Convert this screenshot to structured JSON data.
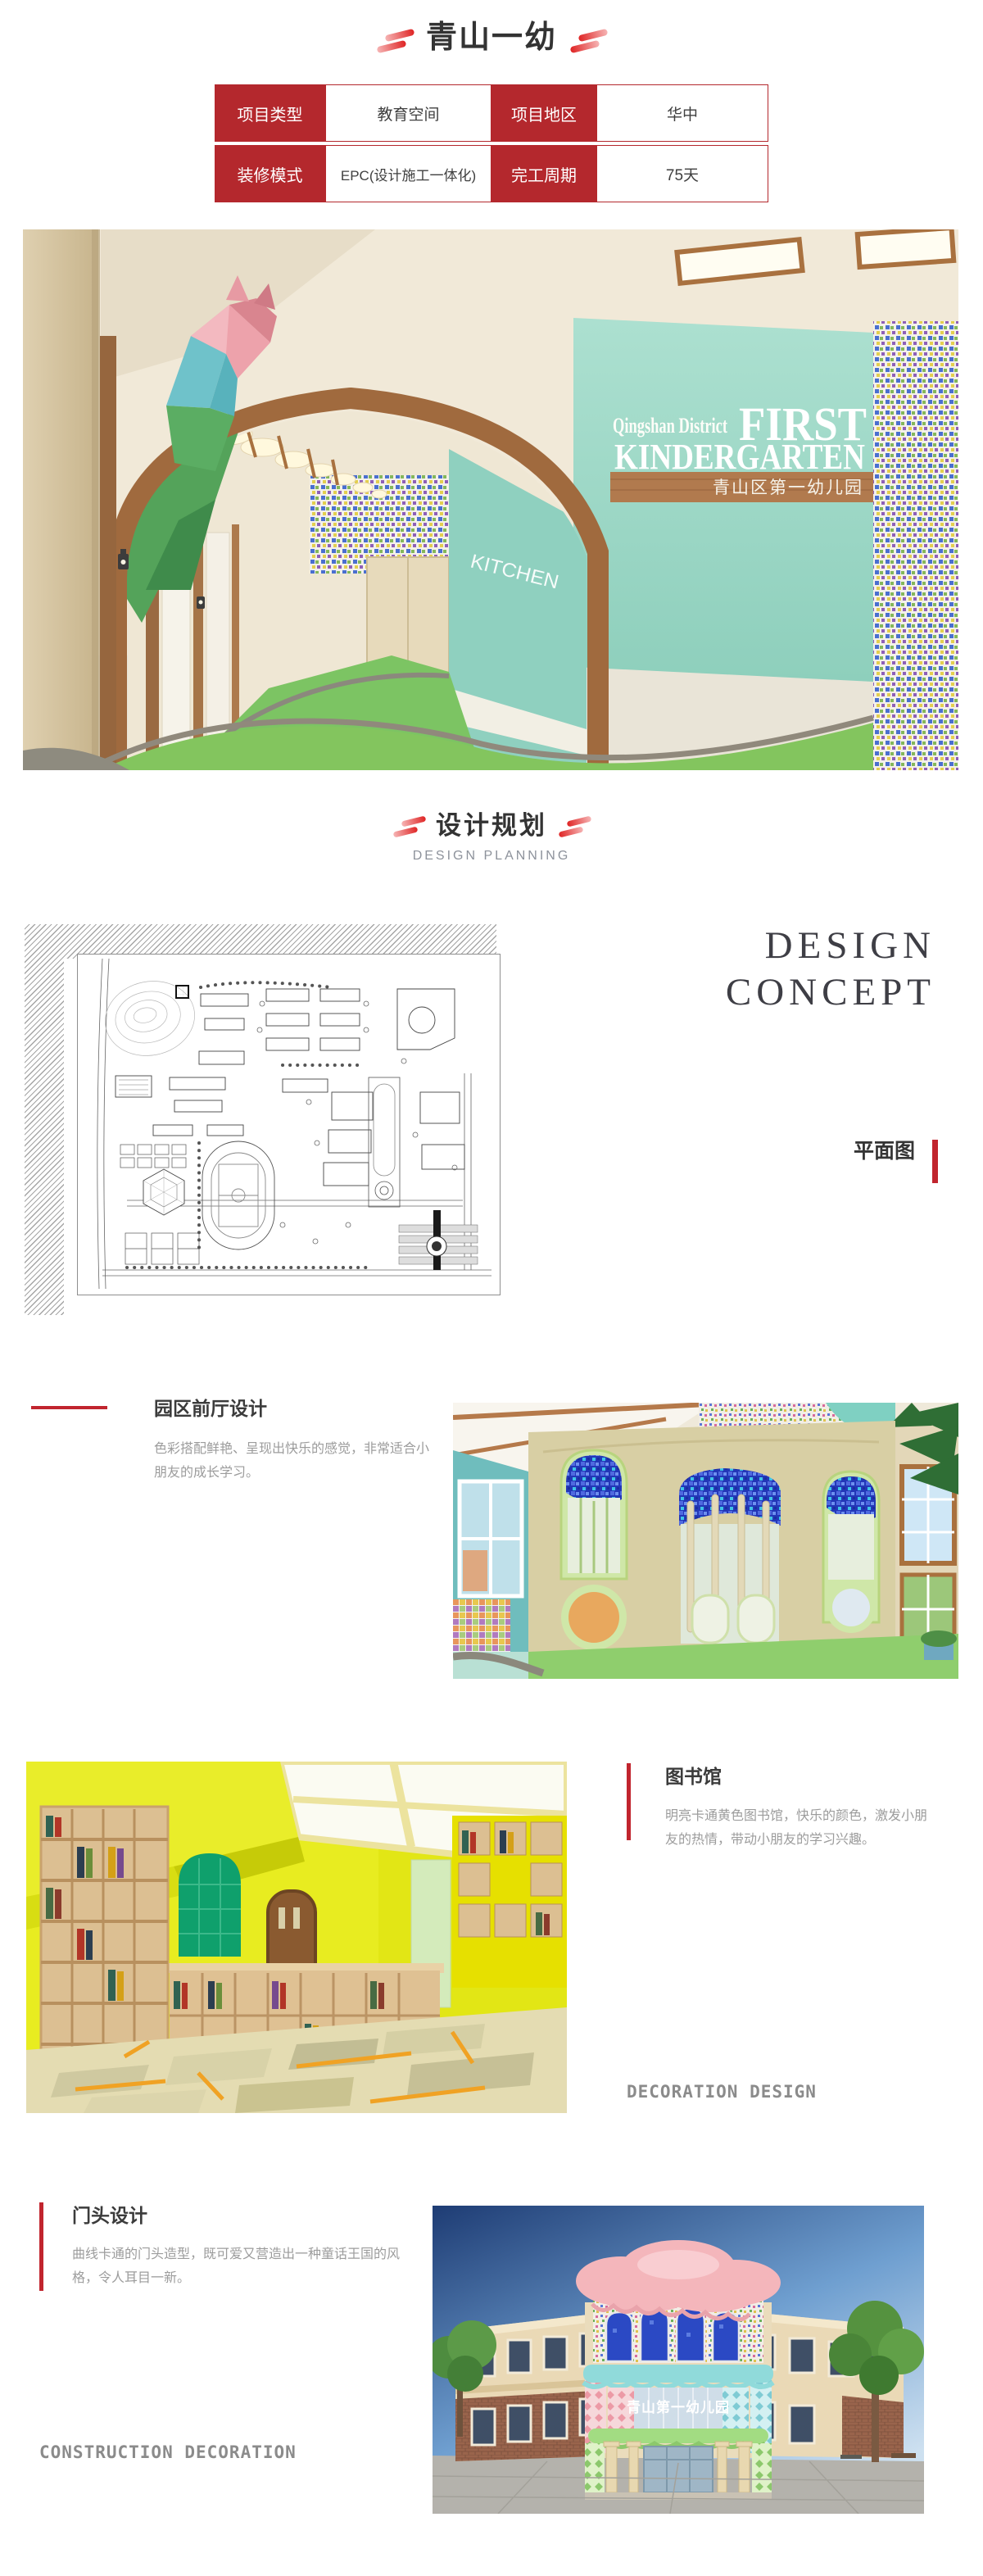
{
  "header": {
    "title": "青山一幼"
  },
  "info_table": {
    "rows": [
      {
        "cells": [
          {
            "kind": "label",
            "text": "项目类型"
          },
          {
            "kind": "value",
            "text": "教育空间"
          },
          {
            "kind": "label",
            "text": "项目地区"
          },
          {
            "kind": "value",
            "text": "华中"
          }
        ]
      },
      {
        "cells": [
          {
            "kind": "label",
            "text": "装修模式"
          },
          {
            "kind": "value",
            "text": "EPC(设计施工一体化)"
          },
          {
            "kind": "label",
            "text": "完工周期"
          },
          {
            "kind": "value",
            "text": "75天"
          }
        ]
      }
    ]
  },
  "hero": {
    "wall_text_small": "Qingshan District",
    "wall_text_line1": "FIRST",
    "wall_text_line2": "KINDERGARTEN",
    "board_text": "青山区第一幼儿园",
    "corridor_label": "KITCHEN"
  },
  "planning_header": {
    "title": "设计规划",
    "subtitle": "DESIGN PLANNING"
  },
  "concept": {
    "line1": "DESIGN",
    "line2": "CONCEPT",
    "plan_label": "平面图"
  },
  "sections": {
    "lobby": {
      "title": "园区前厅设计",
      "description": "色彩搭配鲜艳、呈现出快乐的感觉，非常适合小朋友的成长学习。"
    },
    "library": {
      "title": "图书馆",
      "description": "明亮卡通黄色图书馆，快乐的颜色，激发小朋友的热情，带动小朋友的学习兴趣。",
      "caption": "DECORATION DESIGN"
    },
    "facade": {
      "title": "门头设计",
      "description": "曲线卡通的门头造型，既可爱又营造出一种童话王国的风格，令人耳目一新。",
      "caption": "CONSTRUCTION DECORATION",
      "building_sign": "青山第一幼儿园"
    }
  },
  "colors": {
    "accent_red": "#b4282d",
    "bar_red": "#c1252e",
    "title_dark": "#3a3a3a",
    "body_gray": "#9c9c9c",
    "caption_gray": "#8b8b8b"
  }
}
